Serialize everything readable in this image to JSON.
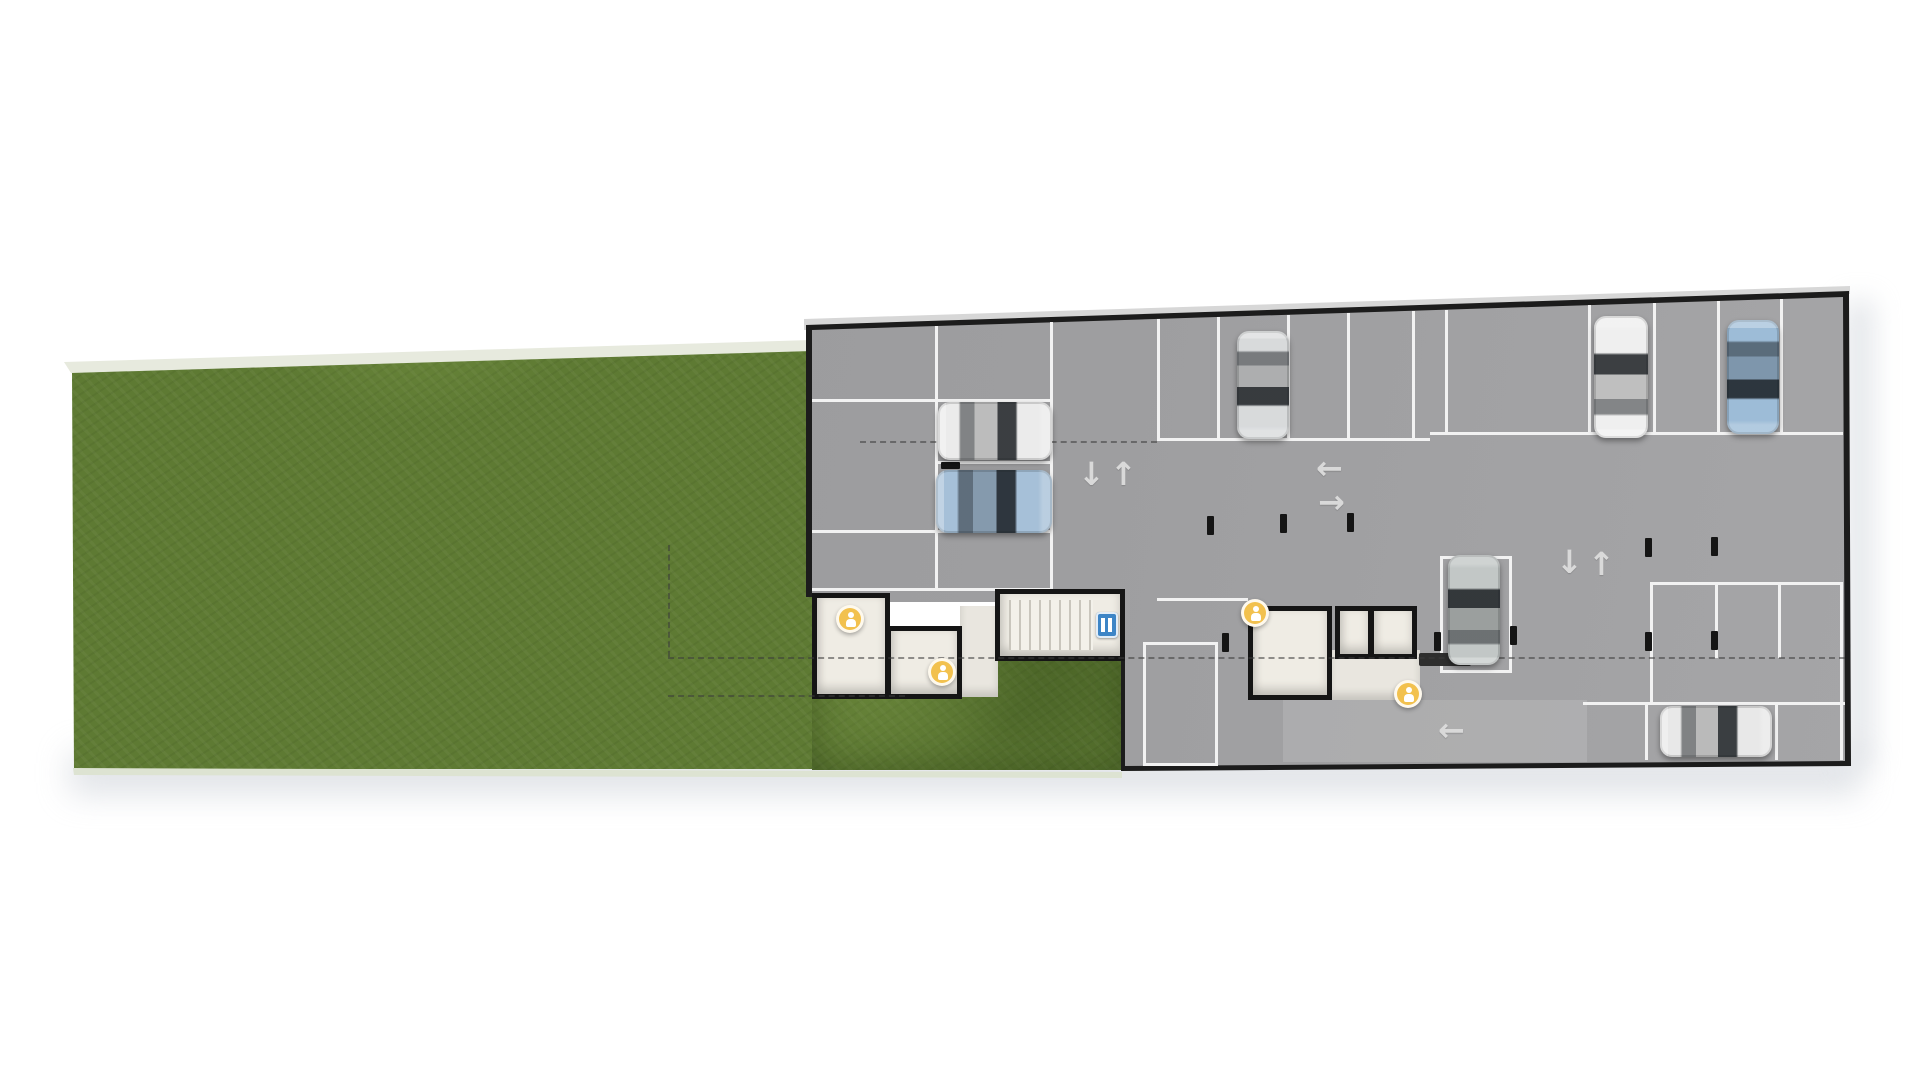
{
  "plan": {
    "kind": "site-plan-parking-level",
    "text_labels": [],
    "palette": {
      "background": "#ffffff",
      "lawn_green": "#5e7a33",
      "floor_gray": "#9c9c9e",
      "outline_dark": "#1c1c1c",
      "stall_line_white": "#f2f2f2",
      "room_fill": "#efece4",
      "marker_yellow": "#f2c14e",
      "elevator_blue": "#3d85c6",
      "dashed_line": "#3c3c3c"
    },
    "arrows": {
      "up": "↑",
      "down": "↓",
      "left": "←",
      "right": "→"
    },
    "cars": [
      {
        "id": "car-1",
        "color": "white",
        "orientation": "horizontal-front-right"
      },
      {
        "id": "car-2",
        "color": "light-blue",
        "orientation": "horizontal-front-right"
      },
      {
        "id": "car-3",
        "color": "silver",
        "orientation": "vertical-front-down"
      },
      {
        "id": "car-4",
        "color": "white",
        "orientation": "vertical-front-up"
      },
      {
        "id": "car-5",
        "color": "light-blue",
        "orientation": "vertical-front-down"
      },
      {
        "id": "car-6",
        "color": "gray",
        "orientation": "vertical-front-up"
      },
      {
        "id": "car-7",
        "color": "white",
        "orientation": "horizontal-front-right"
      }
    ],
    "markers": [
      {
        "id": "marker-1",
        "icon": "amenity-marker",
        "color": "#f2c14e"
      },
      {
        "id": "marker-2",
        "icon": "amenity-marker",
        "color": "#f2c14e"
      },
      {
        "id": "marker-3",
        "icon": "amenity-marker",
        "color": "#f2c14e"
      },
      {
        "id": "marker-4",
        "icon": "amenity-marker",
        "color": "#f2c14e"
      }
    ],
    "features": {
      "stair_core": true,
      "elevator_icon": true,
      "parking_stall_rows": 4,
      "vacant_outlined_stalls": 2,
      "column_ticks": 11
    }
  }
}
